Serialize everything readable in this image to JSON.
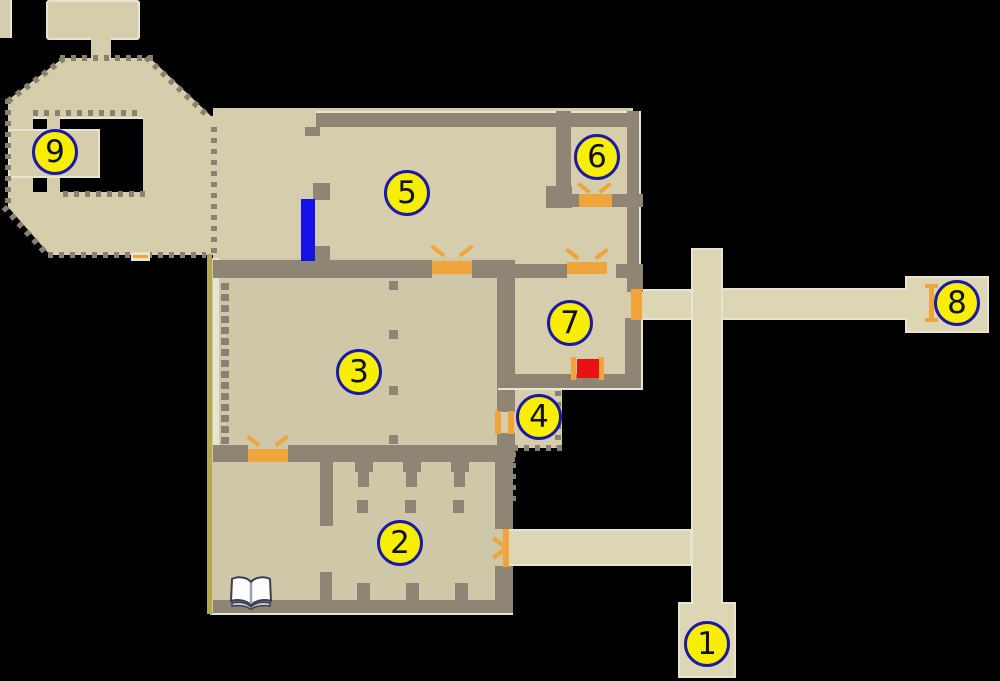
{
  "map_type": "game-level-map",
  "markers": [
    {
      "label": "1",
      "x": 707,
      "y": 644
    },
    {
      "label": "2",
      "x": 400,
      "y": 543
    },
    {
      "label": "3",
      "x": 359,
      "y": 372
    },
    {
      "label": "4",
      "x": 539,
      "y": 417
    },
    {
      "label": "5",
      "x": 407,
      "y": 193
    },
    {
      "label": "6",
      "x": 597,
      "y": 157
    },
    {
      "label": "7",
      "x": 570,
      "y": 323
    },
    {
      "label": "8",
      "x": 957,
      "y": 303
    },
    {
      "label": "9",
      "x": 55,
      "y": 152
    }
  ],
  "colors": {
    "background": "#000000",
    "floor": "#d5cdab",
    "floor_dark": "#cfc8a8",
    "corridor": "#dcd6b4",
    "wall": "#8e8575",
    "dots": "#8a8172",
    "edge_highlight": "#e9e4d0",
    "door_orange": "#f0a43c",
    "marker_fill": "#f8ef00",
    "marker_border": "#1c18a8",
    "barrier_blue": "#1512e8",
    "loot_red": "#e81212",
    "left_border_olive": "#b5a94f"
  },
  "icons": {
    "marker": "numbered-location-marker",
    "book": "open-book-icon",
    "door": "orange-door-marker",
    "barrier": "blue-barrier-marker",
    "loot": "red-loot-marker"
  }
}
